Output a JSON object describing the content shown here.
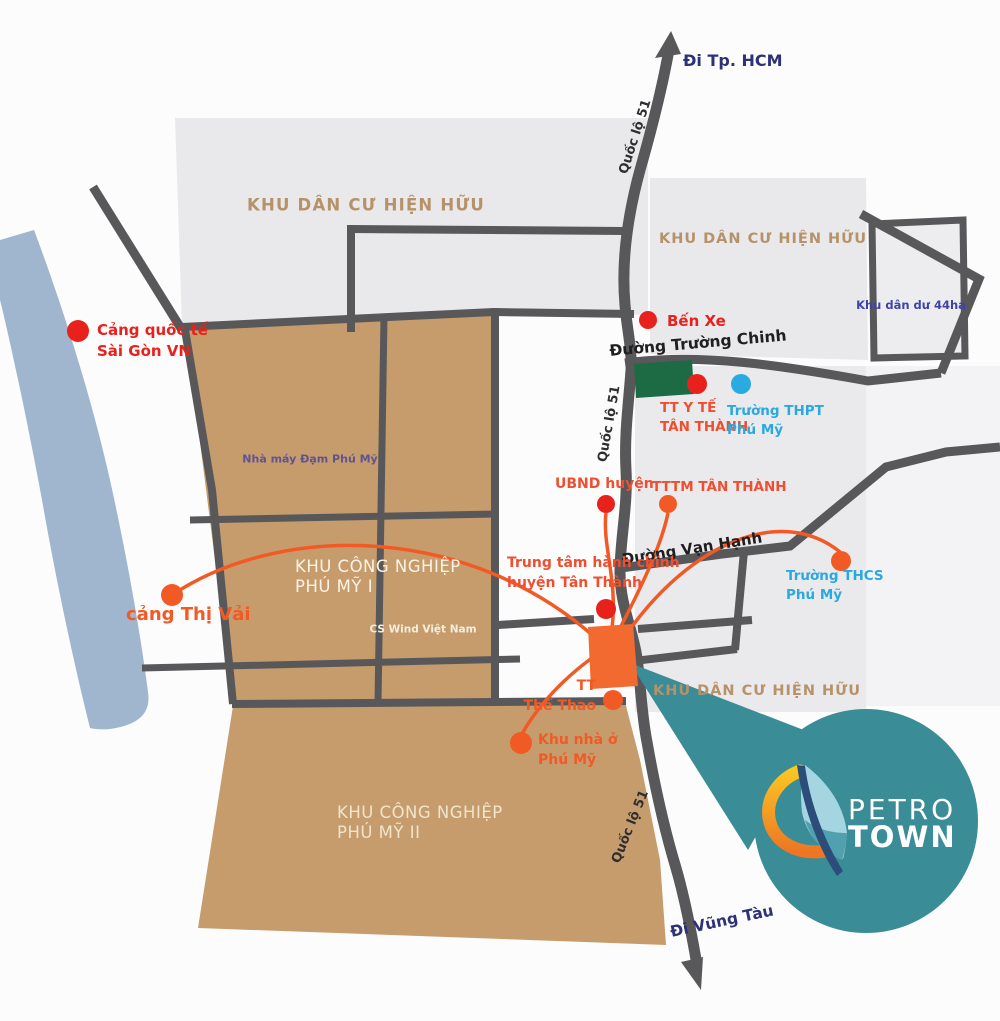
{
  "map": {
    "title": "Petro Town location map - Phu My",
    "colors": {
      "background": "#fcfcfd",
      "river": "#9fb6ce",
      "residential_gray": "#e9e9eb",
      "residential_gray_light": "#f3f3f5",
      "industrial_tan": "#c69c6d",
      "road": "#58585a",
      "green_block": "#1c6b45",
      "project_orange": "#f26a30",
      "connector_orange": "#f15a24",
      "callout_teal": "#3a8c96",
      "poi_red": "#e8211c",
      "poi_orange": "#f15a24",
      "poi_blue": "#29abe2",
      "text_orange_red": "#ef4f30",
      "text_cyan": "#2aa9e0",
      "text_navy": "#2d3178",
      "text_zone_tan": "#b59269",
      "text_indigo": "#3d43a8",
      "text_road": "#2e2e30"
    },
    "directions": [
      {
        "id": "direction-di-tp-hcm",
        "text": "Đi Tp. HCM",
        "x": 683,
        "y": 50,
        "anchor": "left",
        "size": 16,
        "color": "#2d3178",
        "weight": 700
      },
      {
        "id": "direction-di-vung-tau",
        "text": "Đi Vũng Tàu",
        "x": 722,
        "y": 922,
        "anchor": "center",
        "rotate": -12,
        "size": 15.5,
        "color": "#2d3178",
        "weight": 700
      }
    ],
    "road_labels": [
      {
        "id": "road-label-quoc-lo-51-top",
        "text": "Quốc lộ 51",
        "x": 636,
        "y": 137,
        "anchor": "center",
        "rotate": -72,
        "size": 13,
        "color": "#2e2e30",
        "weight": 700
      },
      {
        "id": "road-label-quoc-lo-51-mid",
        "text": "Quốc lộ 51",
        "x": 610,
        "y": 424,
        "anchor": "center",
        "rotate": -80,
        "size": 13,
        "color": "#2e2e30",
        "weight": 700
      },
      {
        "id": "road-label-quoc-lo-51-bottom",
        "text": "Quốc lộ 51",
        "x": 631,
        "y": 827,
        "anchor": "center",
        "rotate": -68,
        "size": 13,
        "color": "#2e2e30",
        "weight": 700
      },
      {
        "id": "road-label-duong-truong-chinh",
        "text": "Đường Trường Chinh",
        "x": 698,
        "y": 344,
        "anchor": "center",
        "rotate": -5,
        "size": 15.5,
        "color": "#1f1f21",
        "weight": 700
      },
      {
        "id": "road-label-duong-van-hanh",
        "text": "Đường Vạn Hạnh",
        "x": 692,
        "y": 549,
        "anchor": "center",
        "rotate": -9,
        "size": 15,
        "color": "#1f1f21",
        "weight": 700
      }
    ],
    "zone_labels": [
      {
        "id": "zone-khu-dan-cu-hien-huu-1",
        "lines": [
          "KHU DÂN CƯ HIỆN HỮU"
        ],
        "x": 366,
        "y": 205,
        "anchor": "center",
        "size": 16.5,
        "color": "#b59269",
        "weight": 700,
        "spacing": 1.2
      },
      {
        "id": "zone-khu-dan-cu-hien-huu-2",
        "lines": [
          "KHU DÂN CƯ HIỆN HỮU"
        ],
        "x": 763,
        "y": 239,
        "anchor": "center",
        "size": 14.5,
        "color": "#b59269",
        "weight": 700,
        "spacing": 1
      },
      {
        "id": "zone-khu-dan-cu-hien-huu-3",
        "lines": [
          "KHU DÂN CƯ HIỆN HỮU"
        ],
        "x": 757,
        "y": 691,
        "anchor": "center",
        "size": 14.5,
        "color": "#b59269",
        "weight": 700,
        "spacing": 1
      },
      {
        "id": "zone-khu-dan-du-44ha",
        "lines": [
          "Khu dân dư 44ha"
        ],
        "x": 911,
        "y": 305,
        "anchor": "center",
        "size": 11.5,
        "color": "#3d43a8",
        "weight": 700
      },
      {
        "id": "zone-kcn-phu-my-1",
        "lines": [
          "KHU CÔNG NGHIỆP",
          "PHÚ MỸ I"
        ],
        "x": 295,
        "y": 557,
        "anchor": "left",
        "size": 16.5,
        "color": "#fbf3e3",
        "weight": 400,
        "spacing": 0.5,
        "lineheight": 1.2
      },
      {
        "id": "zone-kcn-phu-my-2",
        "lines": [
          "KHU CÔNG NGHIỆP",
          "PHÚ MỸ II"
        ],
        "x": 337,
        "y": 803,
        "anchor": "left",
        "size": 16.5,
        "color": "#efe5cc",
        "weight": 400,
        "spacing": 0.5,
        "lineheight": 1.2
      },
      {
        "id": "zone-nha-may-dam-phu-my",
        "lines": [
          "Nhà máy Đạm Phú Mỹ"
        ],
        "x": 310,
        "y": 459,
        "anchor": "center",
        "size": 11,
        "color": "#5e5391",
        "weight": 700
      },
      {
        "id": "zone-cs-wind-viet-nam",
        "lines": [
          "CS Wind Việt Nam"
        ],
        "x": 423,
        "y": 630,
        "anchor": "center",
        "size": 10.5,
        "color": "#f6eedd",
        "weight": 700
      }
    ],
    "pois": [
      {
        "id": "poi-cang-quoc-te-sai-gon",
        "lines": [
          "Cảng quốc tế",
          "Sài Gòn VN"
        ],
        "dot": {
          "x": 78,
          "y": 331,
          "r": 11,
          "color": "#e8211c"
        },
        "label": {
          "x": 97,
          "y": 320,
          "anchor": "left",
          "size": 15,
          "color": "#e8211c"
        }
      },
      {
        "id": "poi-ben-xe",
        "lines": [
          "Bến Xe"
        ],
        "dot": {
          "x": 648,
          "y": 320,
          "r": 9,
          "color": "#e8211c"
        },
        "label": {
          "x": 667,
          "y": 311,
          "anchor": "left",
          "size": 15,
          "color": "#e8211c"
        }
      },
      {
        "id": "poi-tt-y-te-tan-thanh",
        "lines": [
          "TT Y TẾ",
          "TÂN THÀNH"
        ],
        "dot": {
          "x": 697,
          "y": 384,
          "r": 10,
          "color": "#e8211c"
        },
        "label": {
          "x": 660,
          "y": 399,
          "anchor": "left",
          "size": 13.5,
          "color": "#ef4f30"
        }
      },
      {
        "id": "poi-truong-thpt-phu-my",
        "lines": [
          "Trường THPT",
          "Phú Mỹ"
        ],
        "dot": {
          "x": 741,
          "y": 384,
          "r": 10,
          "color": "#29abe2"
        },
        "label": {
          "x": 727,
          "y": 402,
          "anchor": "left",
          "size": 13.5,
          "color": "#2aa9e0"
        }
      },
      {
        "id": "poi-ubnd-huyen",
        "lines": [
          "UBND huyện"
        ],
        "dot": {
          "x": 606,
          "y": 504,
          "r": 9,
          "color": "#e8211c"
        },
        "label": {
          "x": 555,
          "y": 475,
          "anchor": "left",
          "size": 14,
          "color": "#ef4f30"
        }
      },
      {
        "id": "poi-tttm-tan-thanh",
        "lines": [
          "TTTM TÂN THÀNH"
        ],
        "dot": {
          "x": 668,
          "y": 504,
          "r": 9,
          "color": "#f15a24"
        },
        "label": {
          "x": 652,
          "y": 478,
          "anchor": "left",
          "size": 13.5,
          "color": "#ef4f30"
        }
      },
      {
        "id": "poi-trung-tam-hanh-chinh",
        "lines": [
          "Trung tâm hành chính",
          "huyện Tân Thành"
        ],
        "dot": {
          "x": 606,
          "y": 609,
          "r": 10,
          "color": "#e8211c"
        },
        "label": {
          "x": 507,
          "y": 554,
          "anchor": "left",
          "size": 14,
          "color": "#ef4f30"
        }
      },
      {
        "id": "poi-truong-thcs-phu-my",
        "lines": [
          "Trường THCS",
          "Phú Mỹ"
        ],
        "dot": {
          "x": 841,
          "y": 561,
          "r": 10,
          "color": "#f15a24"
        },
        "label": {
          "x": 786,
          "y": 567,
          "anchor": "left",
          "size": 13.5,
          "color": "#2aa9e0"
        }
      },
      {
        "id": "poi-cang-thi-vai",
        "lines": [
          "cảng Thị Vải"
        ],
        "dot": {
          "x": 172,
          "y": 595,
          "r": 11,
          "color": "#f15a24"
        },
        "label": {
          "x": 126,
          "y": 602,
          "anchor": "left",
          "size": 18,
          "color": "#f15a24"
        }
      },
      {
        "id": "poi-tt-the-thao",
        "lines": [
          "TT",
          "Thể Thao"
        ],
        "dot": {
          "x": 613,
          "y": 700,
          "r": 10,
          "color": "#f15a24"
        },
        "label": {
          "x": 596,
          "y": 677,
          "anchor": "right",
          "size": 14,
          "color": "#f15a24"
        }
      },
      {
        "id": "poi-khu-nha-o-phu-my",
        "lines": [
          "Khu nhà ở",
          "Phú Mỹ"
        ],
        "dot": {
          "x": 521,
          "y": 743,
          "r": 11,
          "color": "#f15a24"
        },
        "label": {
          "x": 538,
          "y": 731,
          "anchor": "left",
          "size": 14,
          "color": "#f15a24"
        }
      }
    ],
    "logo": {
      "line1": "PETRO",
      "line2": "TOWN"
    }
  }
}
